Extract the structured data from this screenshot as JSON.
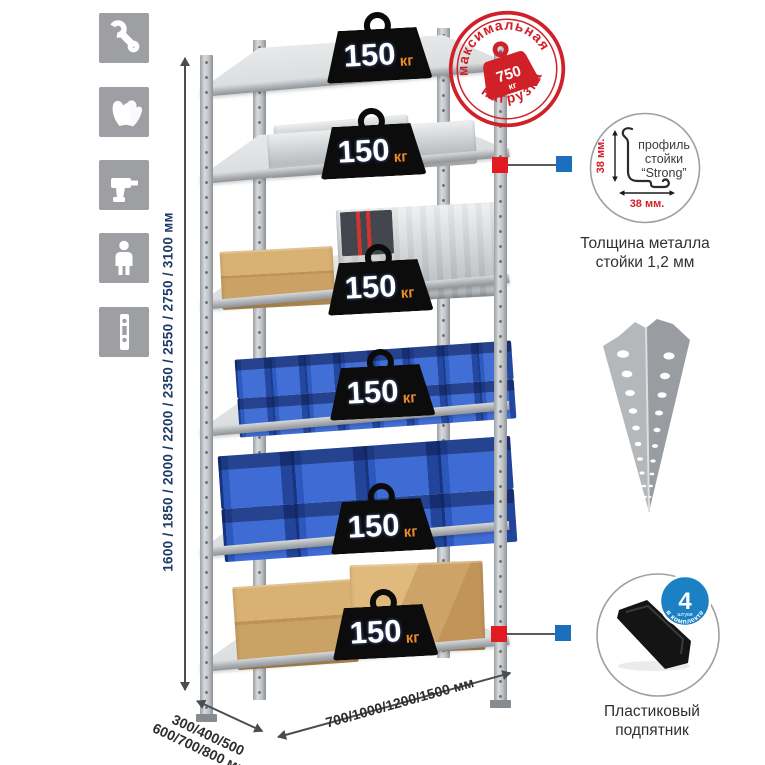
{
  "palette": {
    "stamp_red": "#cf2127",
    "badge_blue": "#1b80c4",
    "connector_red": "#e01b22",
    "connector_blue": "#1b6fbd",
    "dimension_navy": "#1b3a66",
    "bin_blue": "#2c57bd",
    "metal_gray": "#c2c5c8",
    "weight_unit_orange": "#e88a2a"
  },
  "sidebar": {
    "icons": [
      {
        "name": "wrench-icon"
      },
      {
        "name": "gloves-icon"
      },
      {
        "name": "drill-icon"
      },
      {
        "name": "person-icon"
      },
      {
        "name": "perforated-post-icon"
      }
    ]
  },
  "height_dimension": {
    "label": "1600 / 1850 / 2000 / 2200 / 2350 / 2550 / 2750 / 3100 мм"
  },
  "rack": {
    "shelves": [
      {
        "load_value": "150",
        "load_unit": "кг",
        "contents": "empty"
      },
      {
        "load_value": "150",
        "load_unit": "кг",
        "contents": "aluminum-case"
      },
      {
        "load_value": "150",
        "load_unit": "кг",
        "contents": "cardboard-box-and-metal-case"
      },
      {
        "load_value": "150",
        "load_unit": "кг",
        "contents": "small-blue-bins"
      },
      {
        "load_value": "150",
        "load_unit": "кг",
        "contents": "large-blue-bins"
      },
      {
        "load_value": "150",
        "load_unit": "кг",
        "contents": "cardboard-boxes"
      }
    ]
  },
  "max_load_stamp": {
    "arc_top": "максимальная",
    "arc_bottom": "нагрузка",
    "value": "750",
    "unit": "кг"
  },
  "profile_detail": {
    "line1": "профиль",
    "line2": "стойки",
    "line3": "“Strong”",
    "vertical_dim": "38 мм.",
    "horizontal_dim": "38 мм.",
    "caption_line1": "Толщина металла",
    "caption_line2": "стойки 1,2 мм"
  },
  "foot_detail": {
    "badge_value": "4",
    "badge_qty_word": "штуки",
    "badge_arc": "в комплекте",
    "caption_line1": "Пластиковый",
    "caption_line2": "подпятник"
  },
  "bottom_dimensions": {
    "depth_line1": "300/400/500",
    "depth_line2": "600/700/800 мм",
    "width_label": "700/1000/1200/1500 мм"
  }
}
